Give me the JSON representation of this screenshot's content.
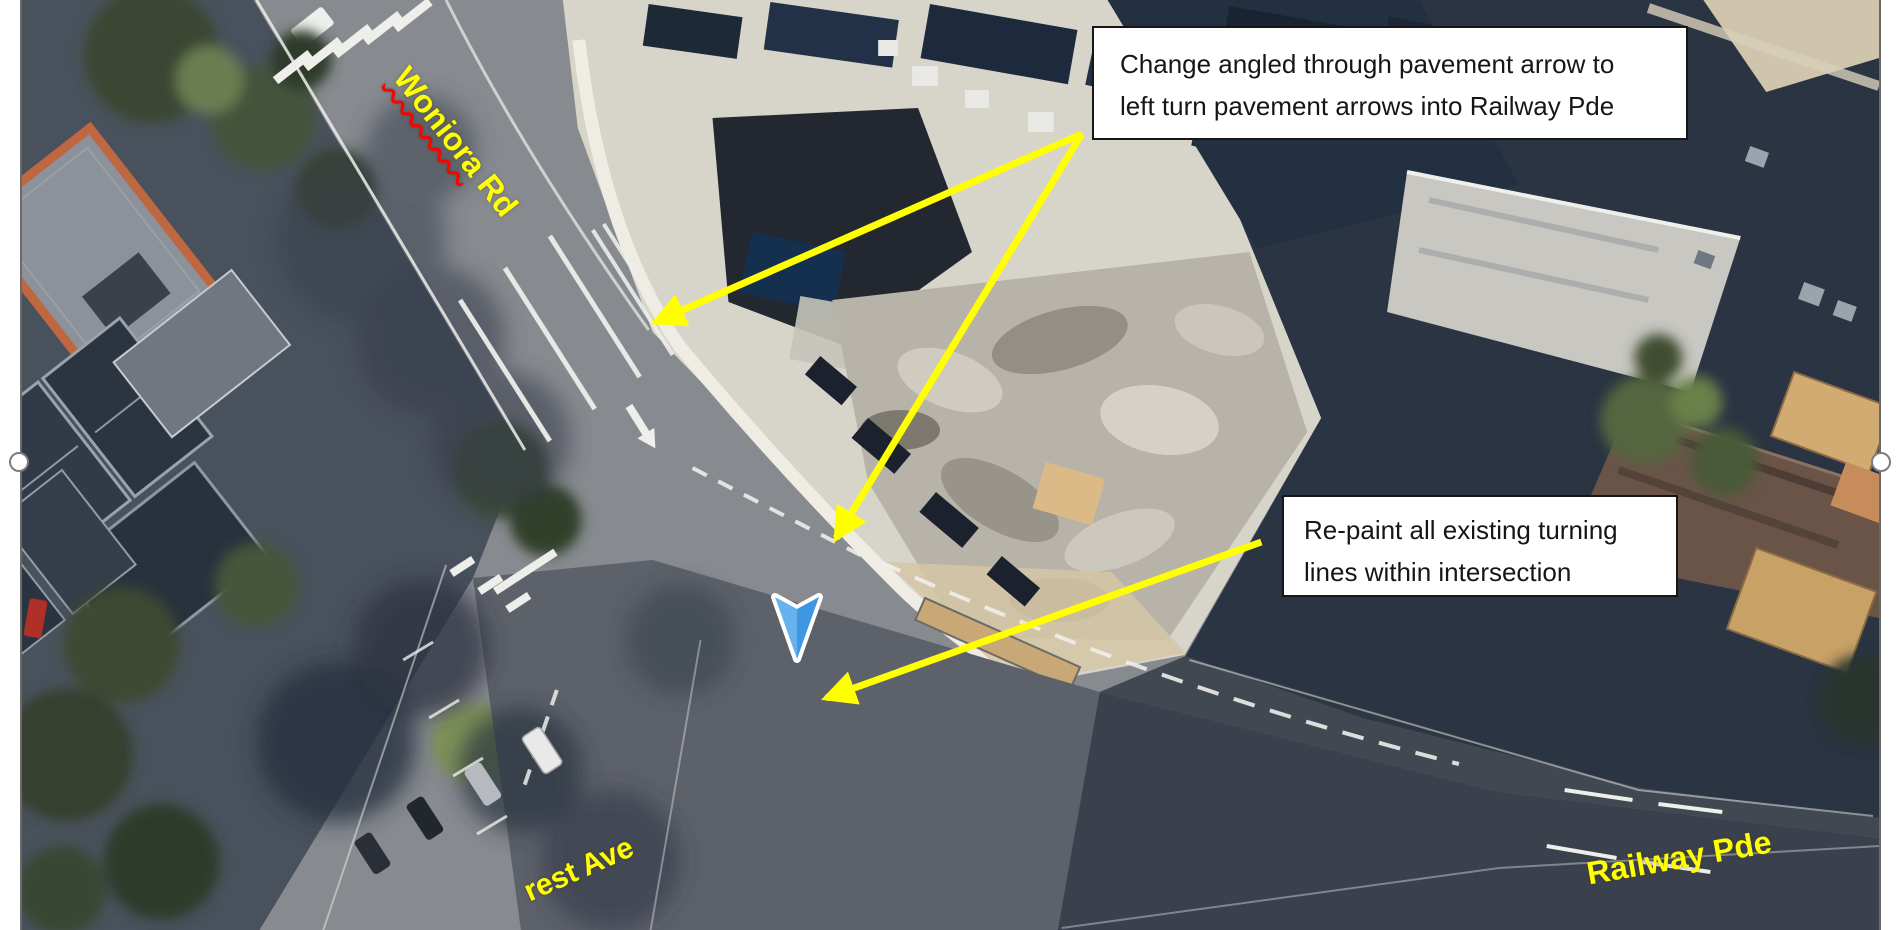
{
  "slide": {
    "background": "#ffffff",
    "image_border": "#6a6a6a"
  },
  "callouts": [
    {
      "id": "callout-change-arrows",
      "lines": [
        "Change angled through pavement arrow to",
        "left turn pavement arrows into Railway Pde"
      ]
    },
    {
      "id": "callout-repaint",
      "lines": [
        "Re-paint all existing turning",
        "lines within intersection"
      ]
    }
  ],
  "annotation_style": {
    "arrow_color": "#ffff00",
    "box_background": "#ffffff",
    "box_border": "#161616",
    "text_color": "#161616"
  },
  "street_labels": {
    "woniora": {
      "word": "Woniora",
      "suffix": " Rd",
      "color": "#ffff00",
      "underline": "#ff0000"
    },
    "forest": {
      "text": "rest Ave",
      "color": "#ffff00"
    },
    "railway": {
      "text": "Railway Pde",
      "color": "#ffff00"
    }
  },
  "map_marker": {
    "type": "navigation-chevron",
    "fill_left": "#68b1ef",
    "fill_right": "#3f97e3",
    "outline": "#ffffff"
  },
  "selection_handles": {
    "fill": "#ffffff",
    "border": "#7d7d7d",
    "positions": [
      "left-middle",
      "right-middle"
    ]
  }
}
